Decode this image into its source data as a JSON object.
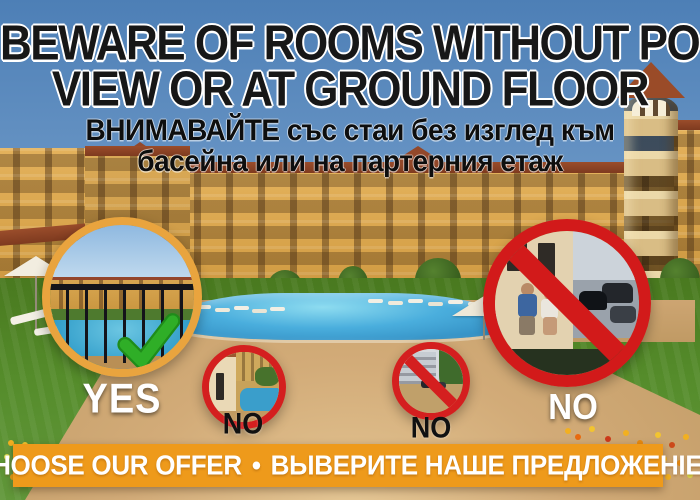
{
  "heading": {
    "line1": "BEWARE OF ROOMS WITHOUT POOL",
    "line2": "VIEW OR AT GROUND FLOOR"
  },
  "subheading": {
    "line1": "ВНИМАВАЙТЕ със стаи без изглед към",
    "line2": "басейна или на партерния етаж"
  },
  "badges": {
    "yes": {
      "label": "YES",
      "icon": "check-icon"
    },
    "no_ground_terrace": {
      "label": "NO",
      "icon": "prohibition-icon"
    },
    "no_street_view": {
      "label": "NO",
      "icon": "prohibition-icon"
    },
    "no_large_terrace": {
      "label": "NO",
      "icon": "prohibition-icon"
    }
  },
  "footer": {
    "cta": "CHOOSE OUR OFFER",
    "separator": "•",
    "translation": "ВЫВЕРИТЕ НАШЕ ПРЕДЛОЖЕНIЕ"
  },
  "colors": {
    "banner_orange": "#ee9a1b",
    "yes_ring_orange": "#e9a43e",
    "no_ring_red": "#d41f1f",
    "check_green": "#2fae27",
    "heading_text": "#171717",
    "footer_text": "#ffffff"
  }
}
